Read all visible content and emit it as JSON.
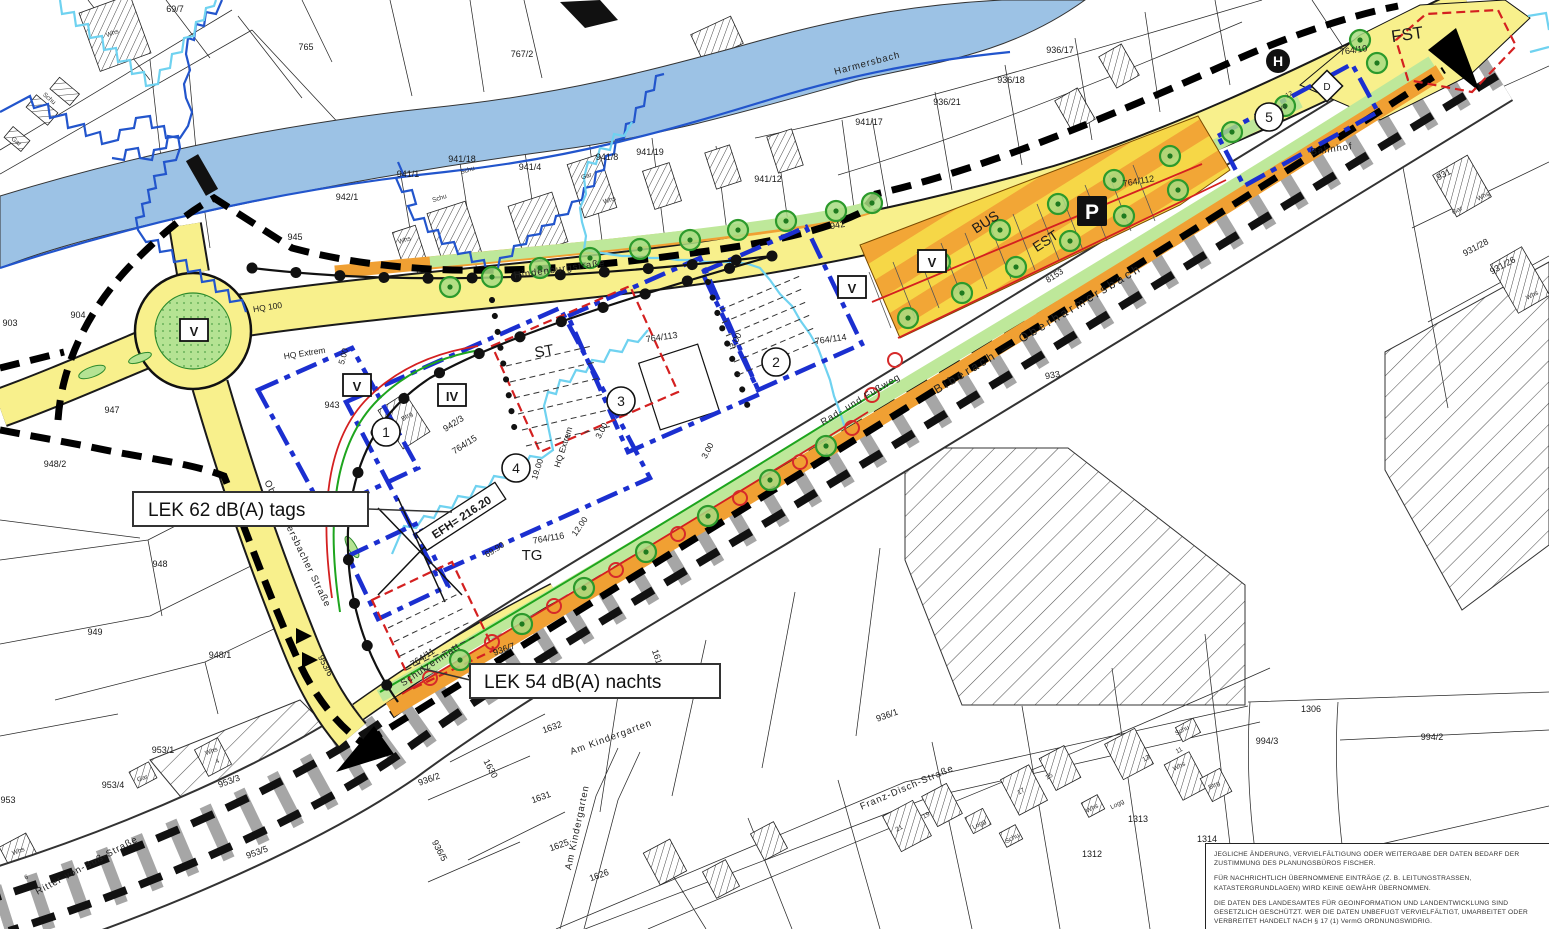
{
  "colors": {
    "road_yellow": "#F8F08C",
    "parking_orange": "#F0A033",
    "green_area": "#BEE89A",
    "river_blue": "#9CC2E5",
    "flood_hq100": "#2255CC",
    "flood_extrem": "#6FD2F0",
    "baugrenze_blue": "#1B2FD0",
    "red_line": "#D42020",
    "railway_gray": "#A6A6A6"
  },
  "map": {
    "callouts": {
      "noise_day": "LEK 62 dB(A) tags",
      "noise_night": "LEK 54 dB(A) nachts",
      "efh": "EFH= 216.20"
    },
    "poi": {
      "parking": "P",
      "bus_stop": "H",
      "bus": "BUS",
      "est": "EST",
      "fst": "FST",
      "st": "ST",
      "tg": "TG",
      "d": "D"
    },
    "streets": {
      "hindenburg": "Hindenburgstraße",
      "river": "Harmersbach",
      "railway": "Biberach — Oberharmersbach",
      "bahnhof": "Bahnhof",
      "radweg": "Rad- und Fußweg",
      "schulzenmatt": "Schulzenmatt",
      "oberharm": "Oberharmersbacher Straße",
      "franz": "Franz-Disch-Straße",
      "kindergarten": "Am Kindergarten",
      "ritter": "Ritter-von-Buß-Straße"
    },
    "circled_numbers": [
      {
        "transform": "translate(386 432)",
        "text": "1"
      },
      {
        "transform": "translate(776 362)",
        "text": "2"
      },
      {
        "transform": "translate(621 401)",
        "text": "3"
      },
      {
        "transform": "translate(516 468)",
        "text": "4"
      },
      {
        "transform": "translate(1269 117)",
        "text": "5"
      }
    ],
    "roman_boxes": [
      {
        "transform": "translate(194 331)",
        "text": "V"
      },
      {
        "transform": "translate(357 386)",
        "text": "V"
      },
      {
        "transform": "translate(452 396)",
        "text": "IV"
      },
      {
        "transform": "translate(852 288)",
        "text": "V"
      },
      {
        "transform": "translate(932 262)",
        "text": "V"
      }
    ],
    "parcel_labels": [
      {
        "x": 306,
        "y": 50,
        "text": "765"
      },
      {
        "x": 522,
        "y": 57,
        "text": "767/2"
      },
      {
        "x": 175,
        "y": 12,
        "text": "69/7"
      },
      {
        "x": 10,
        "y": 326,
        "text": "903"
      },
      {
        "x": 78,
        "y": 318,
        "text": "904"
      },
      {
        "x": 347,
        "y": 200,
        "text": "942/1"
      },
      {
        "x": 295,
        "y": 240,
        "text": "945"
      },
      {
        "x": 332,
        "y": 408,
        "text": "943"
      },
      {
        "x": 838,
        "y": 228,
        "text": "942",
        "transform": "rotate(-10 838 228)"
      },
      {
        "x": 408,
        "y": 177,
        "text": "941/1"
      },
      {
        "x": 462,
        "y": 162,
        "text": "941/18"
      },
      {
        "x": 530,
        "y": 170,
        "text": "941/4"
      },
      {
        "x": 607,
        "y": 160,
        "text": "941/8"
      },
      {
        "x": 650,
        "y": 155,
        "text": "941/19"
      },
      {
        "x": 768,
        "y": 182,
        "text": "941/12"
      },
      {
        "x": 869,
        "y": 125,
        "text": "941/17"
      },
      {
        "x": 947,
        "y": 105,
        "text": "936/21"
      },
      {
        "x": 1011,
        "y": 83,
        "text": "936/18"
      },
      {
        "x": 1060,
        "y": 53,
        "text": "936/17"
      },
      {
        "x": 455,
        "y": 426,
        "text": "942/3",
        "transform": "rotate(-33 455 426)"
      },
      {
        "x": 466,
        "y": 447,
        "text": "764/15",
        "transform": "rotate(-33 466 447)"
      },
      {
        "x": 662,
        "y": 340,
        "text": "764/113",
        "transform": "rotate(-8 662 340)"
      },
      {
        "x": 831,
        "y": 342,
        "text": "764/114",
        "transform": "rotate(-8 831 342)"
      },
      {
        "x": 1139,
        "y": 184,
        "text": "764/112",
        "transform": "rotate(-10 1139 184)"
      },
      {
        "x": 1354,
        "y": 53,
        "text": "764/10",
        "transform": "rotate(-8 1354 53)"
      },
      {
        "x": 549,
        "y": 541,
        "text": "764/116",
        "transform": "rotate(-10 549 541)"
      },
      {
        "x": 424,
        "y": 660,
        "text": "764/11",
        "transform": "rotate(-33 424 660)"
      },
      {
        "x": 1053,
        "y": 378,
        "text": "933",
        "transform": "rotate(-10 1053 378)"
      },
      {
        "x": 1445,
        "y": 177,
        "text": "931",
        "transform": "rotate(-28 1445 177)"
      },
      {
        "x": 1477,
        "y": 250,
        "text": "931/28",
        "transform": "rotate(-28 1477 250)"
      },
      {
        "x": 1504,
        "y": 268,
        "text": "931/26",
        "transform": "rotate(-28 1504 268)"
      },
      {
        "x": 55,
        "y": 467,
        "text": "948/2"
      },
      {
        "x": 112,
        "y": 413,
        "text": "947"
      },
      {
        "x": 160,
        "y": 567,
        "text": "948"
      },
      {
        "x": 95,
        "y": 635,
        "text": "949"
      },
      {
        "x": 220,
        "y": 658,
        "text": "948/1"
      },
      {
        "x": 8,
        "y": 803,
        "text": "953"
      },
      {
        "x": 113,
        "y": 788,
        "text": "953/4"
      },
      {
        "x": 163,
        "y": 753,
        "text": "953/1"
      },
      {
        "x": 230,
        "y": 784,
        "text": "953/3",
        "transform": "rotate(-20 230 784)"
      },
      {
        "x": 258,
        "y": 855,
        "text": "953/5",
        "transform": "rotate(-20 258 855)"
      },
      {
        "x": 323,
        "y": 667,
        "text": "953/6",
        "transform": "rotate(62 323 667)"
      },
      {
        "x": 430,
        "y": 782,
        "text": "936/2",
        "transform": "rotate(-20 430 782)"
      },
      {
        "x": 437,
        "y": 852,
        "text": "936/5",
        "transform": "rotate(62 437 852)"
      },
      {
        "x": 505,
        "y": 652,
        "text": "936/7",
        "transform": "rotate(-20 505 652)"
      },
      {
        "x": 655,
        "y": 660,
        "text": "1619",
        "transform": "rotate(72 655 660)"
      },
      {
        "x": 553,
        "y": 730,
        "text": "1632",
        "transform": "rotate(-20 553 730)"
      },
      {
        "x": 488,
        "y": 770,
        "text": "1630",
        "transform": "rotate(62 488 770)"
      },
      {
        "x": 542,
        "y": 800,
        "text": "1631",
        "transform": "rotate(-20 542 800)"
      },
      {
        "x": 600,
        "y": 878,
        "text": "1626",
        "transform": "rotate(-20 600 878)"
      },
      {
        "x": 560,
        "y": 848,
        "text": "1625",
        "transform": "rotate(-20 560 848)"
      },
      {
        "x": 888,
        "y": 718,
        "text": "936/1",
        "transform": "rotate(-20 888 718)"
      },
      {
        "x": 1311,
        "y": 712,
        "text": "1306"
      },
      {
        "x": 1138,
        "y": 822,
        "text": "1313"
      },
      {
        "x": 1092,
        "y": 857,
        "text": "1312"
      },
      {
        "x": 1207,
        "y": 842,
        "text": "1314"
      },
      {
        "x": 1311,
        "y": 888,
        "text": "1309"
      },
      {
        "x": 1275,
        "y": 892,
        "text": "1310"
      },
      {
        "x": 1240,
        "y": 897,
        "text": "1311"
      },
      {
        "x": 1348,
        "y": 908,
        "text": "1308"
      },
      {
        "x": 1267,
        "y": 744,
        "text": "994/3"
      },
      {
        "x": 1432,
        "y": 740,
        "text": "994/2"
      }
    ],
    "small_labels": [
      {
        "x": 113,
        "y": 35,
        "text": "Whs",
        "transform": "rotate(-20 113 35)"
      },
      {
        "x": 48,
        "y": 100,
        "text": "Schu",
        "transform": "rotate(40 48 100)"
      },
      {
        "x": 15,
        "y": 143,
        "text": "Gar",
        "transform": "rotate(40 15 143)"
      },
      {
        "x": 405,
        "y": 242,
        "text": "Whs",
        "transform": "rotate(-18 405 242)"
      },
      {
        "x": 440,
        "y": 200,
        "text": "Schu",
        "transform": "rotate(-18 440 200)"
      },
      {
        "x": 468,
        "y": 172,
        "text": "Schu",
        "transform": "rotate(-18 468 172)"
      },
      {
        "x": 610,
        "y": 202,
        "text": "Whs",
        "transform": "rotate(-18 610 202)"
      },
      {
        "x": 587,
        "y": 178,
        "text": "Gar",
        "transform": "rotate(-18 587 178)"
      },
      {
        "x": 980,
        "y": 826,
        "text": "Logg",
        "transform": "rotate(-28 980 826)"
      },
      {
        "x": 1013,
        "y": 840,
        "text": "Schu",
        "transform": "rotate(-28 1013 840)"
      },
      {
        "x": 1093,
        "y": 810,
        "text": "Whs",
        "transform": "rotate(-28 1093 810)"
      },
      {
        "x": 1118,
        "y": 806,
        "text": "Logg",
        "transform": "rotate(-28 1118 806)"
      },
      {
        "x": 1183,
        "y": 732,
        "text": "Schu",
        "transform": "rotate(-28 1183 732)"
      },
      {
        "x": 1180,
        "y": 768,
        "text": "Whs",
        "transform": "rotate(-28 1180 768)"
      },
      {
        "x": 1215,
        "y": 787,
        "text": "Btrg",
        "transform": "rotate(-28 1215 787)"
      },
      {
        "x": 143,
        "y": 780,
        "text": "Gar",
        "transform": "rotate(-20 143 780)"
      },
      {
        "x": 19,
        "y": 853,
        "text": "Whs",
        "transform": "rotate(-20 19 853)"
      },
      {
        "x": 212,
        "y": 753,
        "text": "Whs",
        "transform": "rotate(-20 212 753)"
      },
      {
        "x": 1458,
        "y": 212,
        "text": "Gar",
        "transform": "rotate(-28 1458 212)"
      },
      {
        "x": 1484,
        "y": 198,
        "text": "Whs",
        "transform": "rotate(-28 1484 198)"
      },
      {
        "x": 1533,
        "y": 297,
        "text": "Whs",
        "transform": "rotate(-28 1533 297)"
      },
      {
        "x": 408,
        "y": 418,
        "text": "Btrg",
        "transform": "rotate(-33 408 418)"
      },
      {
        "x": 900,
        "y": 830,
        "text": "21",
        "transform": "rotate(-28 900 830)"
      },
      {
        "x": 927,
        "y": 817,
        "text": "19",
        "transform": "rotate(-28 927 817)"
      },
      {
        "x": 1022,
        "y": 793,
        "text": "17",
        "transform": "rotate(-28 1022 793)"
      },
      {
        "x": 1050,
        "y": 778,
        "text": "15",
        "transform": "rotate(-28 1050 778)"
      },
      {
        "x": 1147,
        "y": 760,
        "text": "13",
        "transform": "rotate(-28 1147 760)"
      },
      {
        "x": 1180,
        "y": 752,
        "text": "11",
        "transform": "rotate(-28 1180 752)"
      },
      {
        "x": 218,
        "y": 763,
        "text": "4",
        "transform": "rotate(-20 218 763)"
      },
      {
        "x": 27,
        "y": 879,
        "text": "6",
        "transform": "rotate(-20 27 879)"
      },
      {
        "x": 1290,
        "y": 96,
        "text": "12",
        "transform": "rotate(-28 1290 96)"
      },
      {
        "x": 1281,
        "y": 110,
        "text": "Wvg",
        "transform": "rotate(-28 1281 110)"
      }
    ],
    "dim_labels": [
      {
        "x": 268,
        "y": 310,
        "text": "HQ 100",
        "transform": "rotate(-9 268 310)"
      },
      {
        "x": 305,
        "y": 356,
        "text": "HQ Extrem",
        "transform": "rotate(-9 305 356)"
      },
      {
        "x": 566,
        "y": 448,
        "text": "HQ Extrem",
        "transform": "rotate(-72 566 448)"
      },
      {
        "x": 540,
        "y": 470,
        "text": "19.00",
        "transform": "rotate(-72 540 470)"
      },
      {
        "x": 582,
        "y": 528,
        "text": "12.00",
        "transform": "rotate(-55 582 528)"
      },
      {
        "x": 496,
        "y": 552,
        "text": "69.90",
        "transform": "rotate(-33 496 552)"
      },
      {
        "x": 346,
        "y": 357,
        "text": "5.00",
        "transform": "rotate(-75 346 357)"
      },
      {
        "x": 738,
        "y": 342,
        "text": "3.00",
        "transform": "rotate(-62 738 342)"
      },
      {
        "x": 710,
        "y": 452,
        "text": "3.00",
        "transform": "rotate(-62 710 452)"
      },
      {
        "x": 604,
        "y": 432,
        "text": "3.00",
        "transform": "rotate(-62 604 432)"
      },
      {
        "x": 1056,
        "y": 278,
        "text": "8153",
        "transform": "rotate(-33 1056 278)"
      }
    ],
    "trees": [
      {
        "transform": "translate(450 287)"
      },
      {
        "transform": "translate(492 277)"
      },
      {
        "transform": "translate(540 268)"
      },
      {
        "transform": "translate(590 258)"
      },
      {
        "transform": "translate(640 249)"
      },
      {
        "transform": "translate(690 240)"
      },
      {
        "transform": "translate(738 230)"
      },
      {
        "transform": "translate(786 221)"
      },
      {
        "transform": "translate(836 211)"
      },
      {
        "transform": "translate(872 203)"
      },
      {
        "transform": "translate(940 262)"
      },
      {
        "transform": "translate(1000 230)"
      },
      {
        "transform": "translate(1058 204)"
      },
      {
        "transform": "translate(1114 180)"
      },
      {
        "transform": "translate(1170 156)"
      },
      {
        "transform": "translate(908 318)"
      },
      {
        "transform": "translate(962 293)"
      },
      {
        "transform": "translate(1016 267)"
      },
      {
        "transform": "translate(1070 241)"
      },
      {
        "transform": "translate(1124 216)"
      },
      {
        "transform": "translate(1178 190)"
      },
      {
        "transform": "translate(1232 132)"
      },
      {
        "transform": "translate(1285 106)"
      },
      {
        "transform": "translate(1360 40)"
      },
      {
        "transform": "translate(1377 63)"
      },
      {
        "transform": "translate(460 660)"
      },
      {
        "transform": "translate(522 624)"
      },
      {
        "transform": "translate(584 588)"
      },
      {
        "transform": "translate(646 552)"
      },
      {
        "transform": "translate(708 516)"
      },
      {
        "transform": "translate(770 480)"
      },
      {
        "transform": "translate(826 446)"
      }
    ],
    "red_rings": [
      {
        "cx": 430,
        "cy": 678
      },
      {
        "cx": 492,
        "cy": 642
      },
      {
        "cx": 554,
        "cy": 606
      },
      {
        "cx": 616,
        "cy": 570
      },
      {
        "cx": 678,
        "cy": 534
      },
      {
        "cx": 740,
        "cy": 498
      },
      {
        "cx": 800,
        "cy": 462
      },
      {
        "cx": 852,
        "cy": 428
      },
      {
        "cx": 872,
        "cy": 395
      },
      {
        "cx": 895,
        "cy": 360
      }
    ]
  },
  "disclaimer": {
    "p1": "JEGLICHE ÄNDERUNG, VERVIELFÄLTIGUNG ODER WEITERGABE DER DATEN BEDARF DER ZUSTIMMUNG DES PLANUNGSBÜROS FISCHER.",
    "p2": "FÜR NACHRICHTLICH ÜBERNOMMENE EINTRÄGE (Z. B. LEITUNGSTRASSEN, KATASTERGRUNDLAGEN) WIRD KEINE GEWÄHR ÜBERNOMMEN.",
    "p3": "DIE DATEN DES LANDESAMTES FÜR GEOINFORMATION UND LANDENTWICKLUNG SIND GESETZLICH GESCHÜTZT. WER DIE DATEN UNBEFUGT VERVIELFÄLTIGT, UMARBEITET ODER VERBREITET HANDELT NACH § 17 (1) VermG ORDNUNGSWIDRIG."
  }
}
